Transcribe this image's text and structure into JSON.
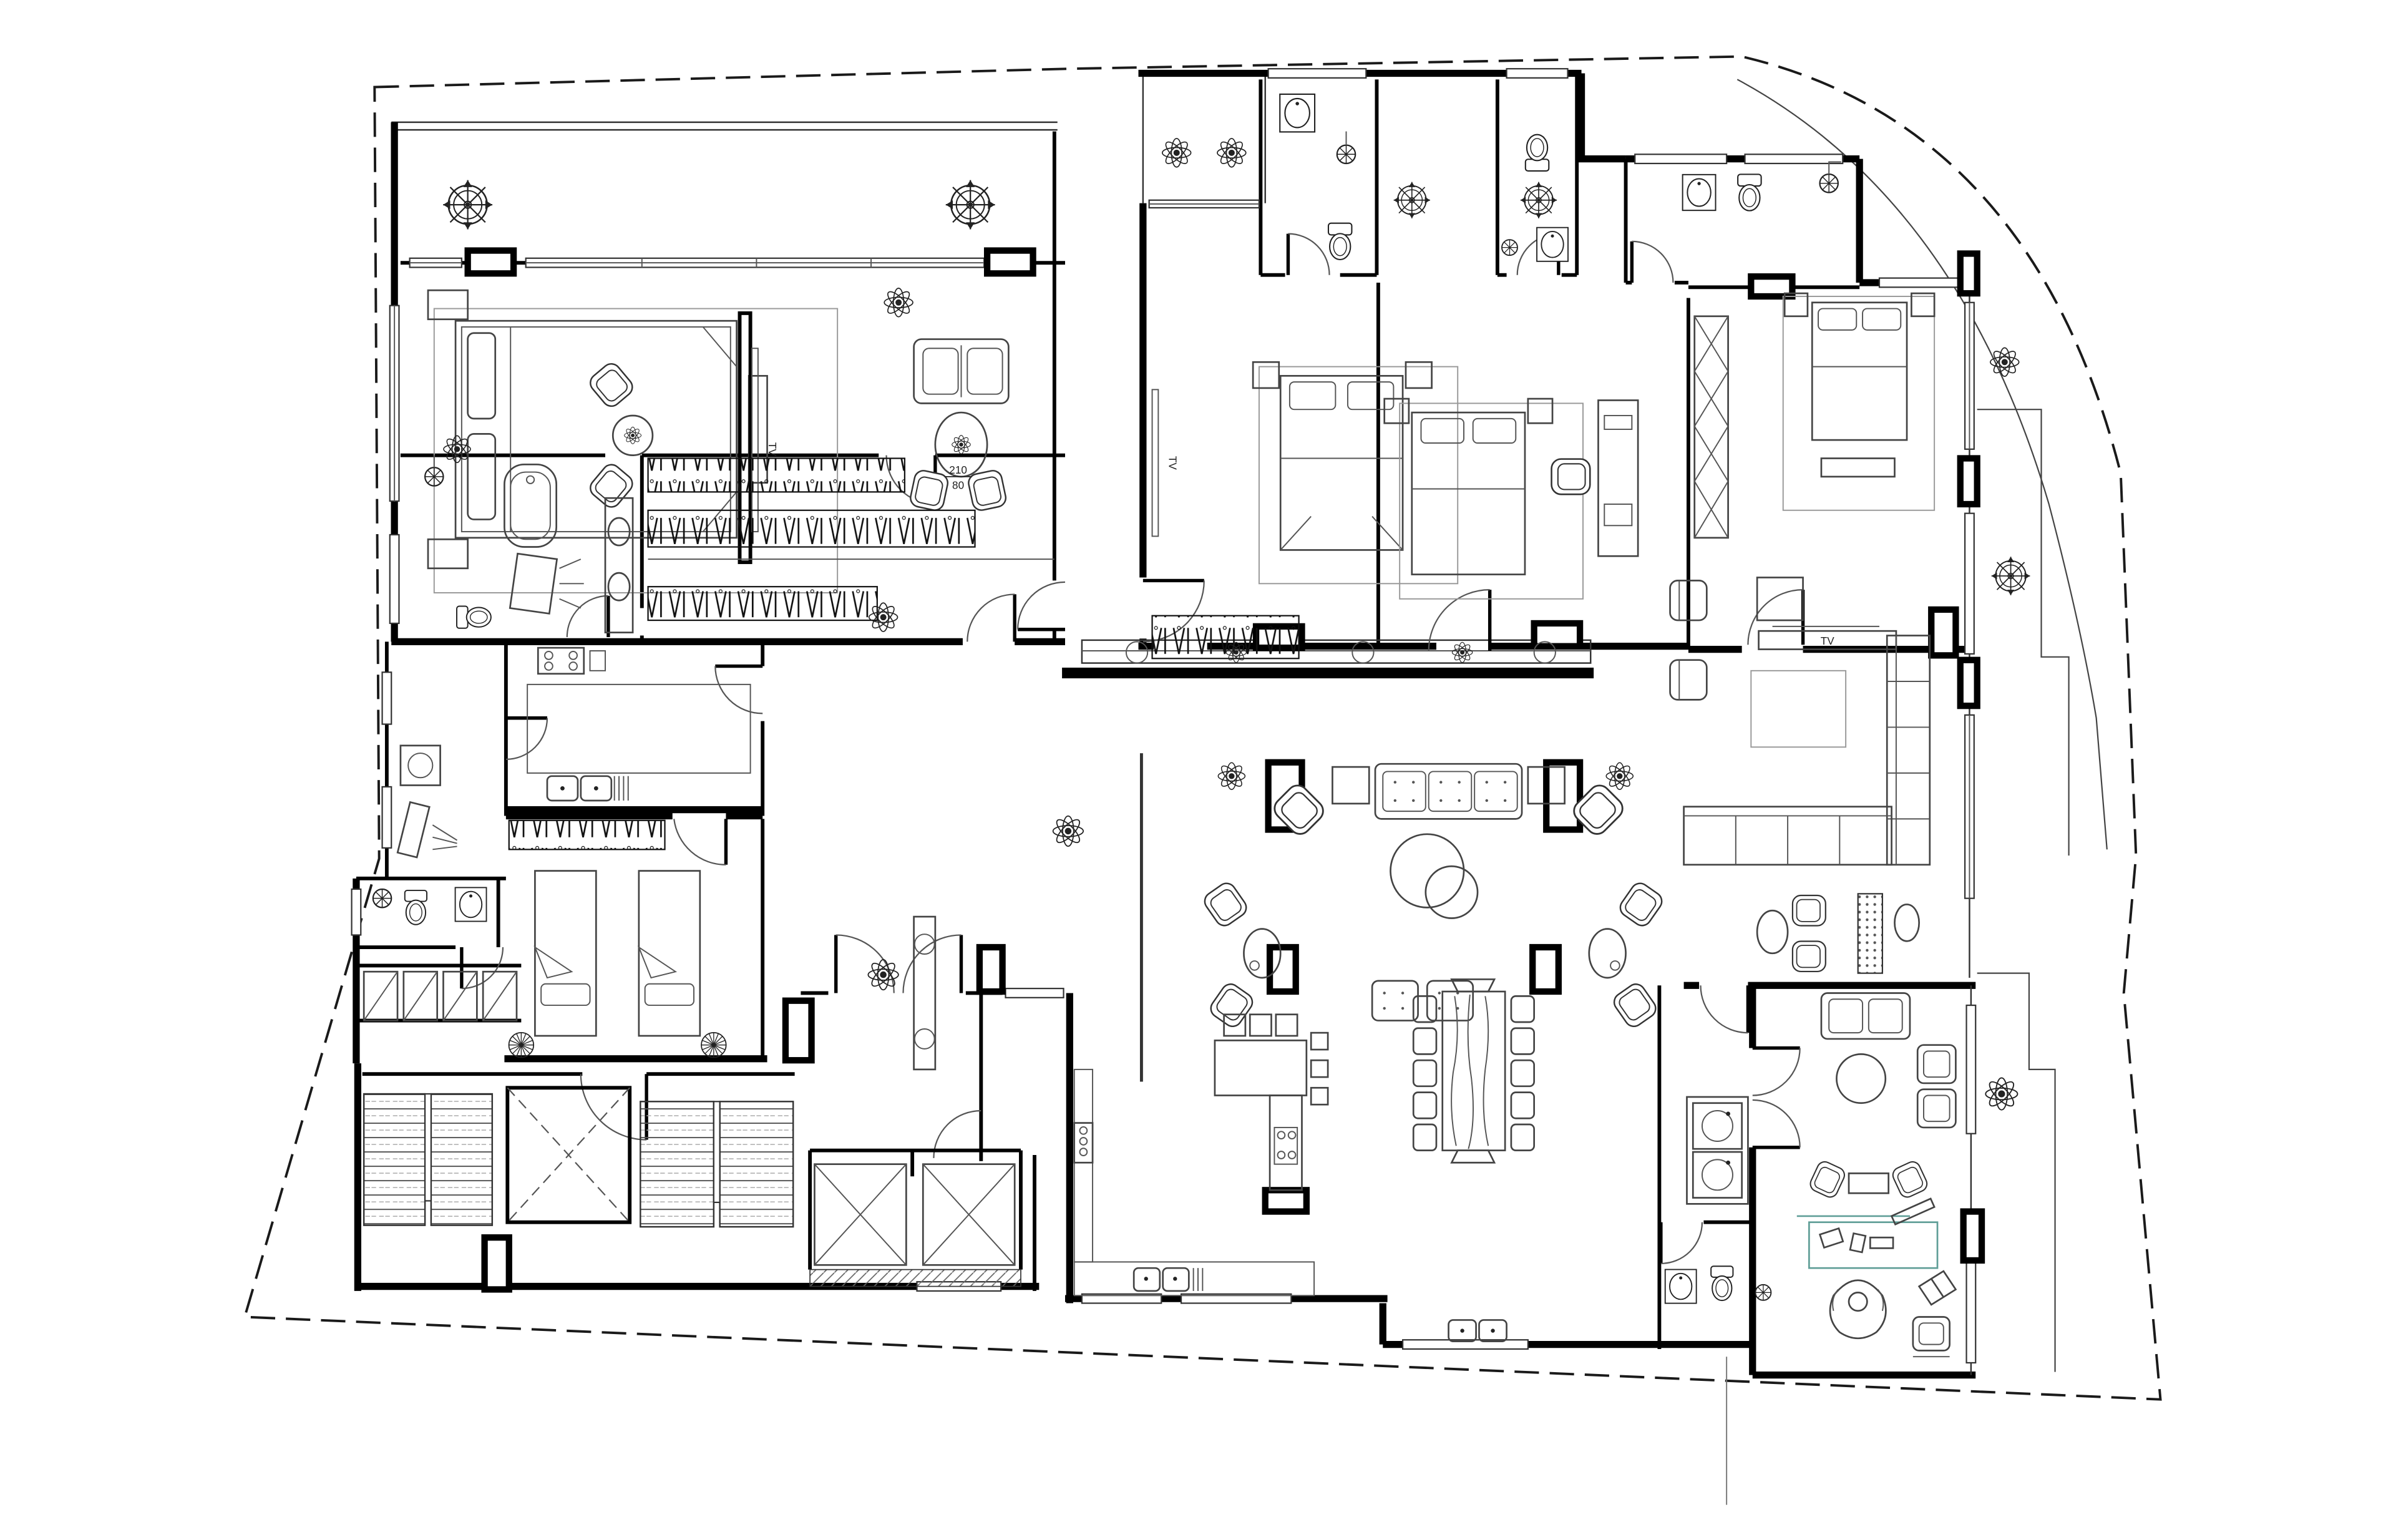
{
  "title": "Apartment floor plan with furniture layout",
  "labels": {
    "tv": "TV",
    "door_width": "210",
    "door_height": "80"
  },
  "colors": {
    "wall": "#000000",
    "line": "#333333",
    "thin_line": "#666666",
    "boundary": "#1a1a1a",
    "accent_desk": "#5f9e97",
    "background": "#ffffff"
  },
  "symbols": [
    "wheel-tree-icon",
    "flower-plant-icon",
    "shower-head-icon",
    "toilet-icon",
    "sink-icon",
    "bathtub-icon",
    "bed-icon",
    "sofa-icon",
    "armchair-icon",
    "dining-table-icon",
    "bar-stool-icon",
    "stair-treads-icon",
    "elevator-x-icon",
    "hanger-rack-icon",
    "washing-machine-icon",
    "ceiling-fan-icon",
    "tv-panel-icon"
  ]
}
